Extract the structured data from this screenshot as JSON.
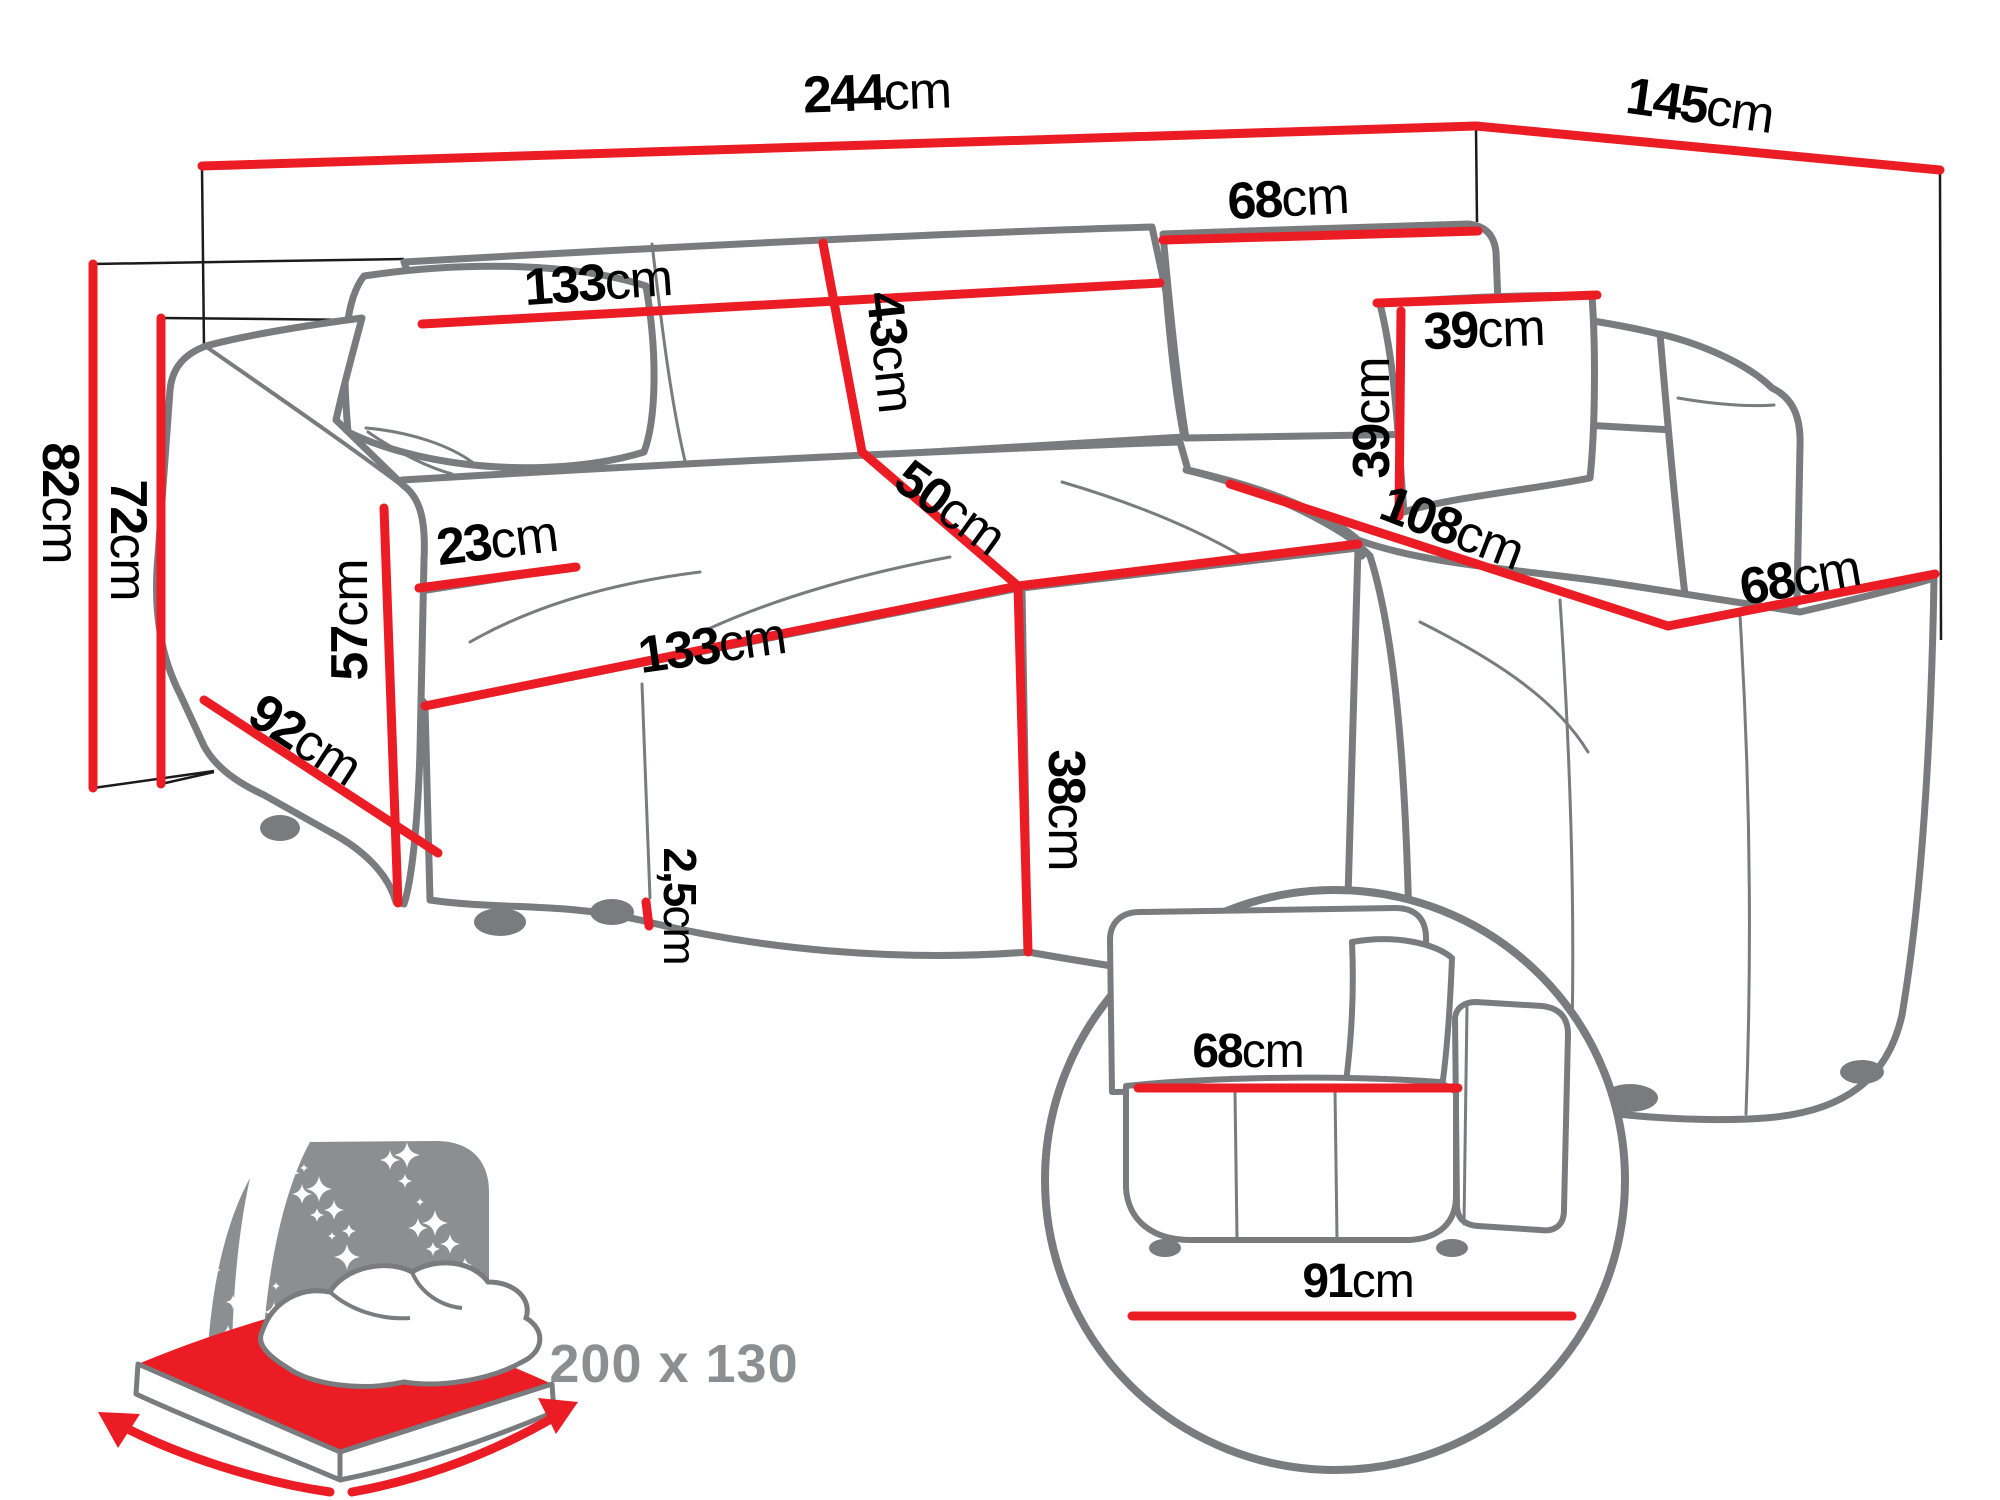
{
  "diagram_title": "",
  "colors": {
    "accent": "#EC1C24",
    "outline": "#797B7E",
    "text": "#000000",
    "muted": "#8C8F92"
  },
  "bed_badge": {
    "label": "200 x 130"
  },
  "icons": {
    "bed_icon": "sleeping-function-bed-icon",
    "inset_icon": "side-view-detail-circle"
  },
  "labels": [
    {
      "id": "total-width",
      "num": "244",
      "unit": "cm",
      "x": 877,
      "y": 93,
      "rot": -2,
      "size": 52
    },
    {
      "id": "total-depth",
      "num": "145",
      "unit": "cm",
      "x": 1700,
      "y": 106,
      "rot": 8,
      "size": 52
    },
    {
      "id": "corner-backrest-width",
      "num": "68",
      "unit": "cm",
      "x": 1288,
      "y": 199,
      "rot": -3,
      "size": 52
    },
    {
      "id": "backrest-width",
      "num": "133",
      "unit": "cm",
      "x": 598,
      "y": 283,
      "rot": -4,
      "size": 52
    },
    {
      "id": "backrest-height",
      "num": "43",
      "unit": "cm",
      "x": 890,
      "y": 352,
      "rot": 84,
      "size": 52
    },
    {
      "id": "corner-seat-width",
      "num": "50",
      "unit": "cm",
      "x": 950,
      "y": 508,
      "rot": 36,
      "size": 52
    },
    {
      "id": "seat-width",
      "num": "133",
      "unit": "cm",
      "x": 712,
      "y": 646,
      "rot": -8,
      "size": 52
    },
    {
      "id": "armrest-width",
      "num": "23",
      "unit": "cm",
      "x": 497,
      "y": 541,
      "rot": -7,
      "size": 52
    },
    {
      "id": "armrest-front-height",
      "num": "57",
      "unit": "cm",
      "x": 350,
      "y": 620,
      "rot": -90,
      "size": 52
    },
    {
      "id": "side-depth",
      "num": "92",
      "unit": "cm",
      "x": 305,
      "y": 740,
      "rot": 33,
      "size": 52
    },
    {
      "id": "seat-height",
      "num": "38",
      "unit": "cm",
      "x": 1066,
      "y": 810,
      "rot": 90,
      "size": 52
    },
    {
      "id": "leg-height",
      "num": "2,5",
      "unit": "cm",
      "x": 680,
      "y": 906,
      "rot": 90,
      "size": 46
    },
    {
      "id": "pillow-width",
      "num": "39",
      "unit": "cm",
      "x": 1484,
      "y": 330,
      "rot": -2,
      "size": 52
    },
    {
      "id": "pillow-height",
      "num": "39",
      "unit": "cm",
      "x": 1372,
      "y": 418,
      "rot": -90,
      "size": 52
    },
    {
      "id": "chaise-length",
      "num": "108",
      "unit": "cm",
      "x": 1452,
      "y": 528,
      "rot": 21,
      "size": 52
    },
    {
      "id": "chaise-seat-width",
      "num": "68",
      "unit": "cm",
      "x": 1800,
      "y": 578,
      "rot": -10,
      "size": 52
    },
    {
      "id": "total-height",
      "num": "82",
      "unit": "cm",
      "x": 60,
      "y": 503,
      "rot": 90,
      "size": 52
    },
    {
      "id": "wall-side-height",
      "num": "72",
      "unit": "cm",
      "x": 128,
      "y": 540,
      "rot": 90,
      "size": 52
    },
    {
      "id": "inset-seat-depth",
      "num": "68",
      "unit": "cm",
      "x": 1248,
      "y": 1052,
      "rot": 0,
      "size": 48
    },
    {
      "id": "inset-total-depth",
      "num": "91",
      "unit": "cm",
      "x": 1358,
      "y": 1282,
      "rot": 0,
      "size": 48
    }
  ]
}
